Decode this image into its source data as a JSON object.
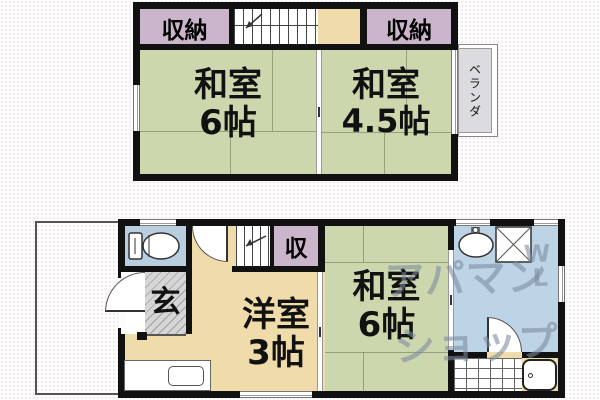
{
  "floor2": {
    "closet_left": "収納",
    "closet_right": "収納",
    "room_left": {
      "name": "和室",
      "size": "6帖"
    },
    "room_right": {
      "name": "和室",
      "size": "4.5帖"
    },
    "veranda": "ベランダ"
  },
  "floor1": {
    "entrance": "玄",
    "closet": "収",
    "western_room": {
      "name": "洋室",
      "size": "3帖"
    },
    "japanese_room": {
      "name": "和室",
      "size": "6帖"
    }
  },
  "watermark": {
    "line1": "アパマン",
    "line2": "ショップ",
    "mark1": "W",
    "mark2": "L"
  },
  "colors": {
    "tatami_room": "#cdd7ae",
    "wood_floor": "#f0dcaa",
    "closet": "#cbb5cb",
    "toilet": "#b9cfe0",
    "sanitary": "#bdd3e6",
    "entrance_gray": "#d6d6d6",
    "veranda_gray": "#dcdce0",
    "wall": "#111111",
    "watermark": "#8290a0"
  }
}
